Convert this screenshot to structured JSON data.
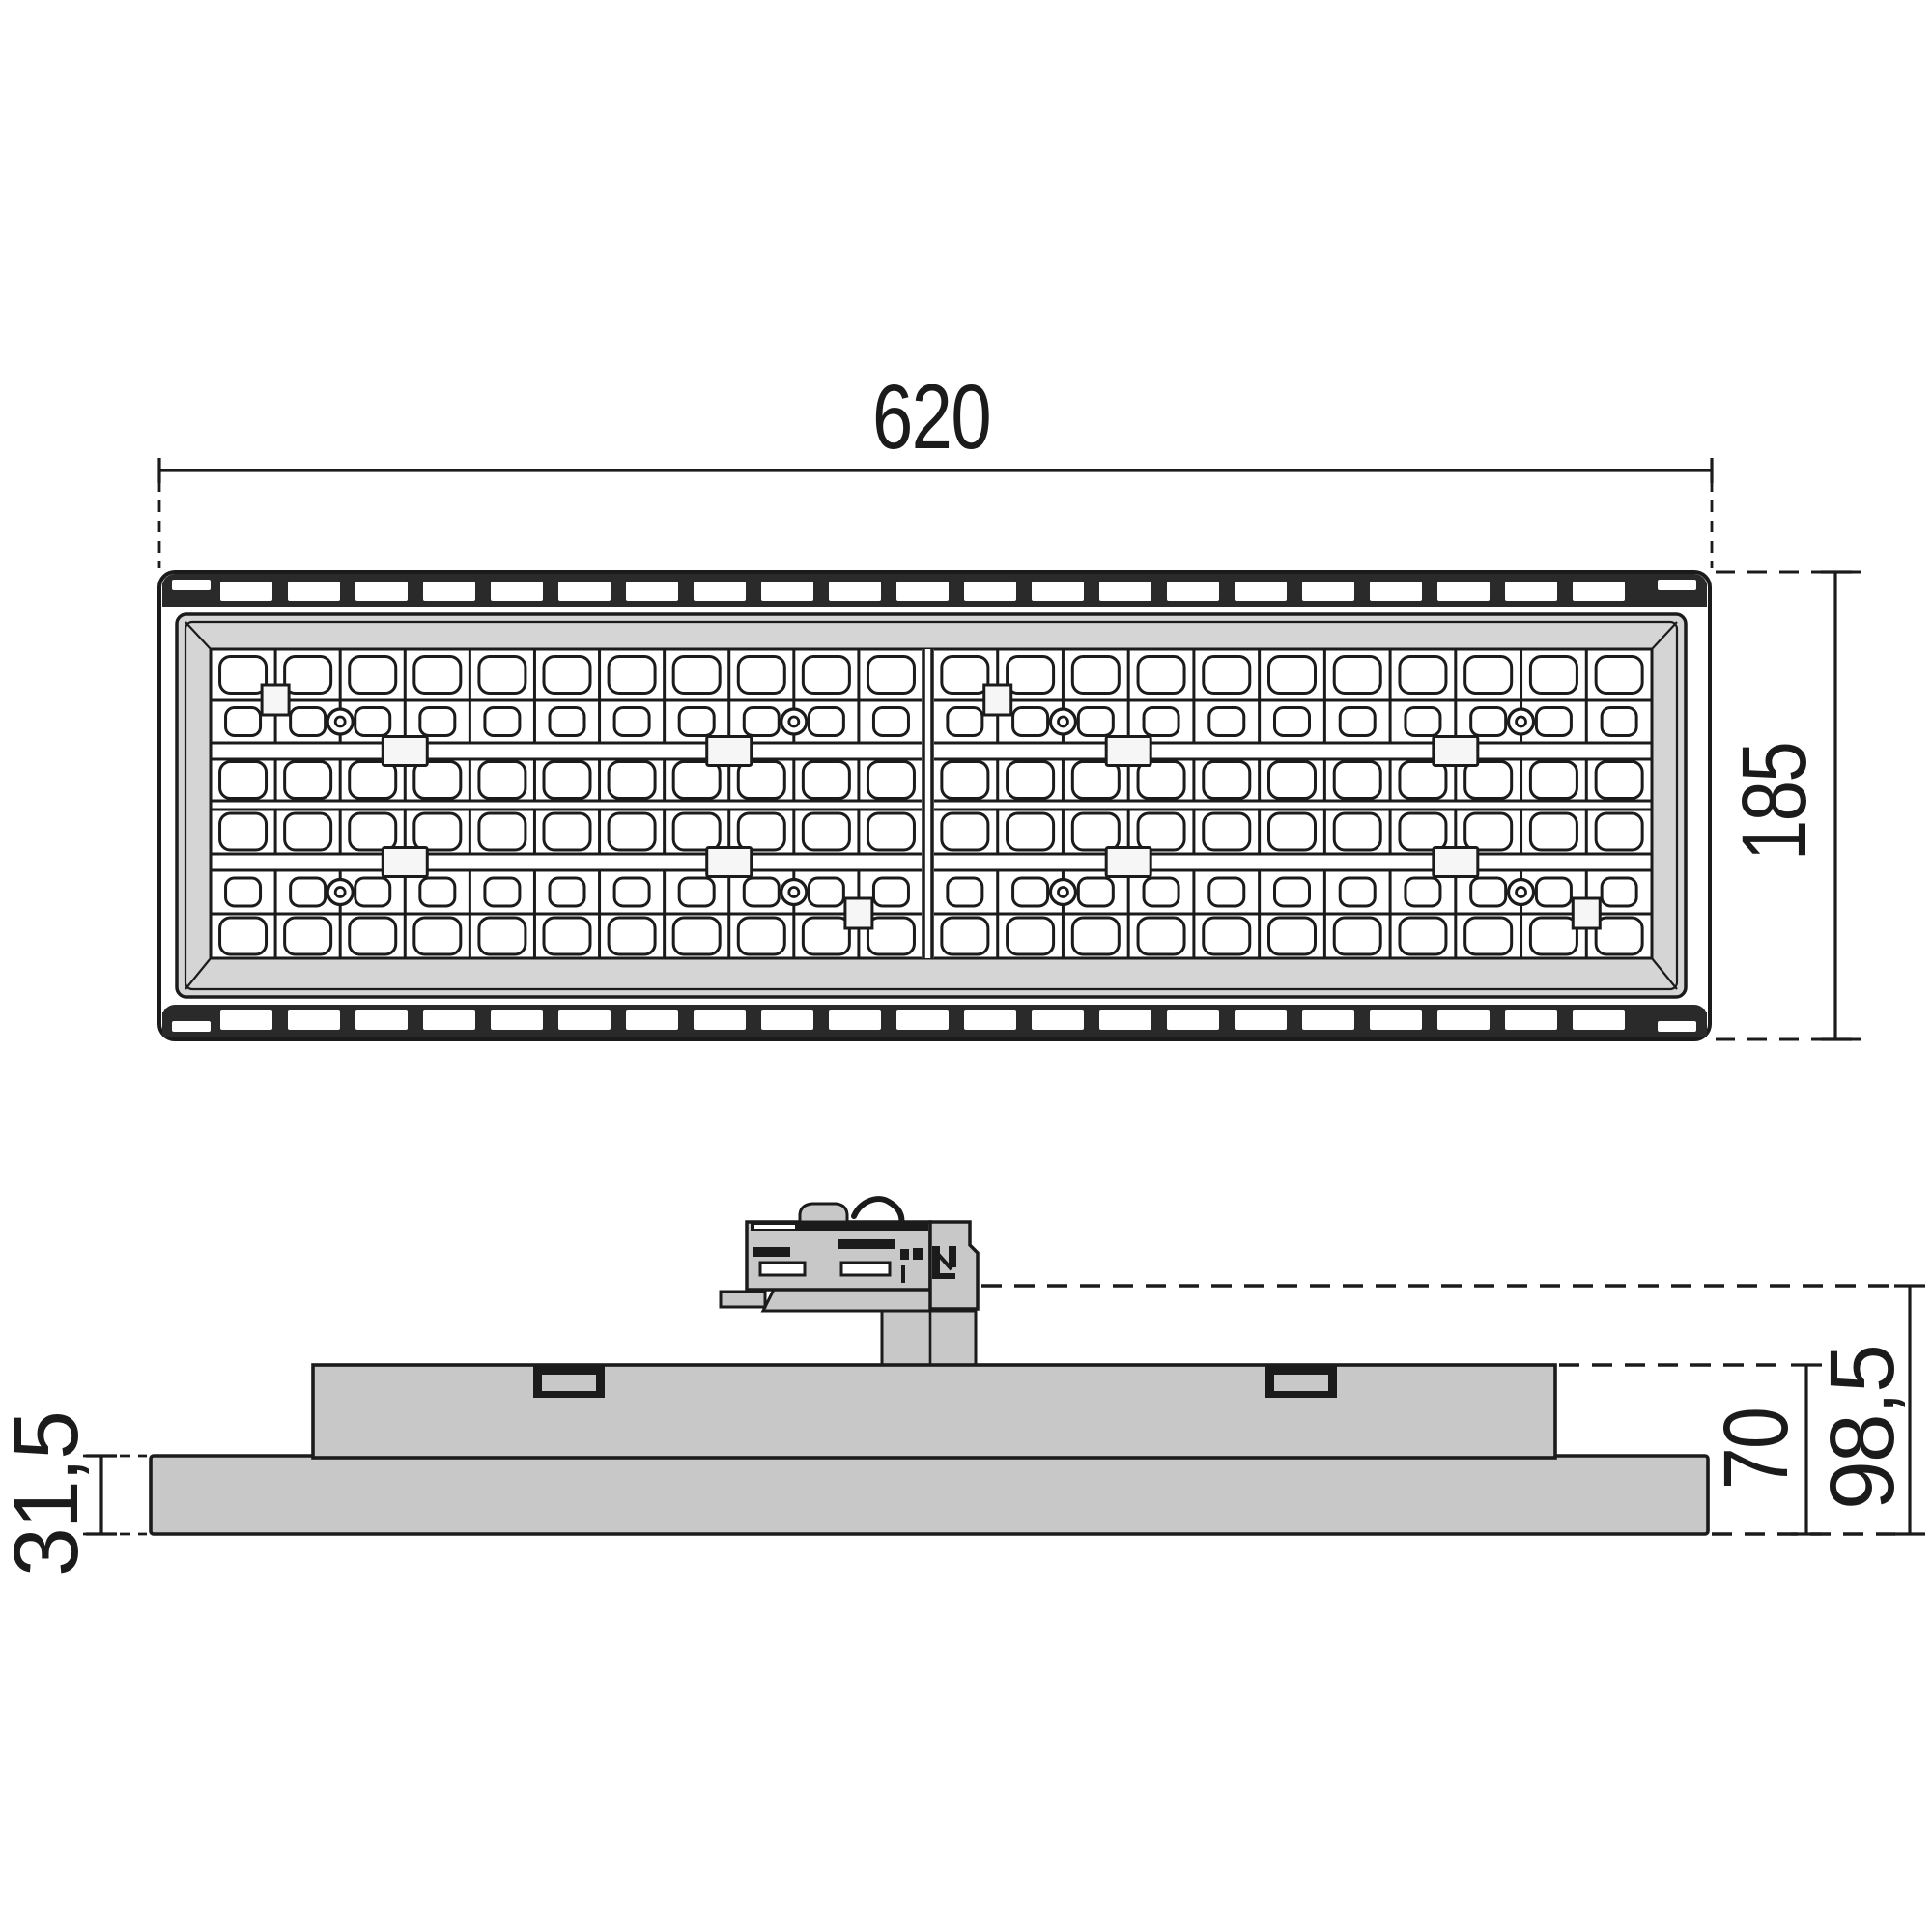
{
  "title": "Luminaire technical dimension drawing",
  "labels": {
    "width": "620",
    "height": "185",
    "head_height": "31,5",
    "body_height": "70",
    "total_height": "98,5"
  },
  "colors": {
    "line": "#1b1b1b",
    "body_gray": "#c8c8c8",
    "bezel_gray": "#d5d5d5",
    "band_dark": "#2a2a2a",
    "background": "#ffffff"
  },
  "led_array": {
    "modules": 2,
    "columns_per_module": 11,
    "big_lens_rows": 4,
    "small_lens_rows": 2,
    "features": {
      "top_square_line": 1,
      "circle_lines": [
        2,
        9
      ],
      "bar_square_lines": [
        3,
        8
      ],
      "bottom_square_line": 10
    }
  }
}
